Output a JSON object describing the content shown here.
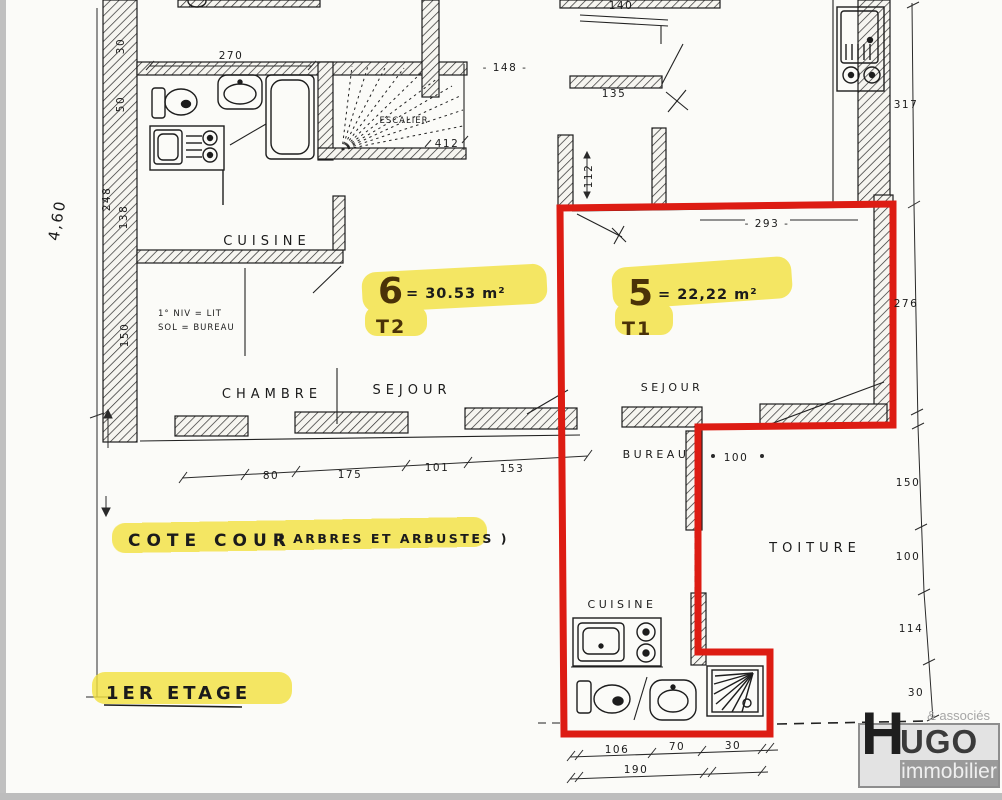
{
  "colors": {
    "red_outline": "#dd1c13",
    "highlight": "#f3e23e",
    "ink": "#1b1b1b",
    "logo_gray": "#9a9a9a"
  },
  "plan": {
    "apartments": [
      {
        "number": "6",
        "area": "= 30.53 m²",
        "type": "T2"
      },
      {
        "number": "5",
        "area": "= 22,22 m²",
        "type": "T1"
      }
    ],
    "rooms": {
      "cuisine_top": "CUISINE",
      "chambre": "CHAMBRE",
      "sejour_left": "SEJOUR",
      "sejour_right": "SEJOUR",
      "bureau": "BUREAU",
      "escalier": "ESCALIER",
      "toiture": "TOITURE",
      "cuisine_bottom": "CUISINE"
    },
    "notes": {
      "cote_cour_main": "COTE COUR",
      "cote_cour_paren": "( ARBRES ET ARBUSTES )",
      "etage": "1ER ETAGE",
      "mezz_line1": "1° NIV = LIT",
      "mezz_line2": "SOL = BUREAU"
    },
    "dimensions": {
      "d270": "270",
      "d148": "- 148 -",
      "d140": "140",
      "d135": "135",
      "d112": "112",
      "d412": "412",
      "d317": "317",
      "d293": "- 293 -",
      "d276": "276",
      "d80": "80",
      "d175": "175",
      "d101": "101",
      "d153": "153",
      "d100": "100",
      "d150r": "150",
      "d100r": "100",
      "d114r": "114",
      "d30r": "30",
      "d106": "106",
      "d70": "70",
      "d30b": "30",
      "d190": "190",
      "d30l": "30",
      "d50l": "50",
      "d248": "248",
      "d138": "138",
      "d150l": "150",
      "d460": "4,60"
    }
  },
  "logo": {
    "tagline": "& associés",
    "initial": "H",
    "rest": "UGO",
    "line2": "immobilier"
  }
}
